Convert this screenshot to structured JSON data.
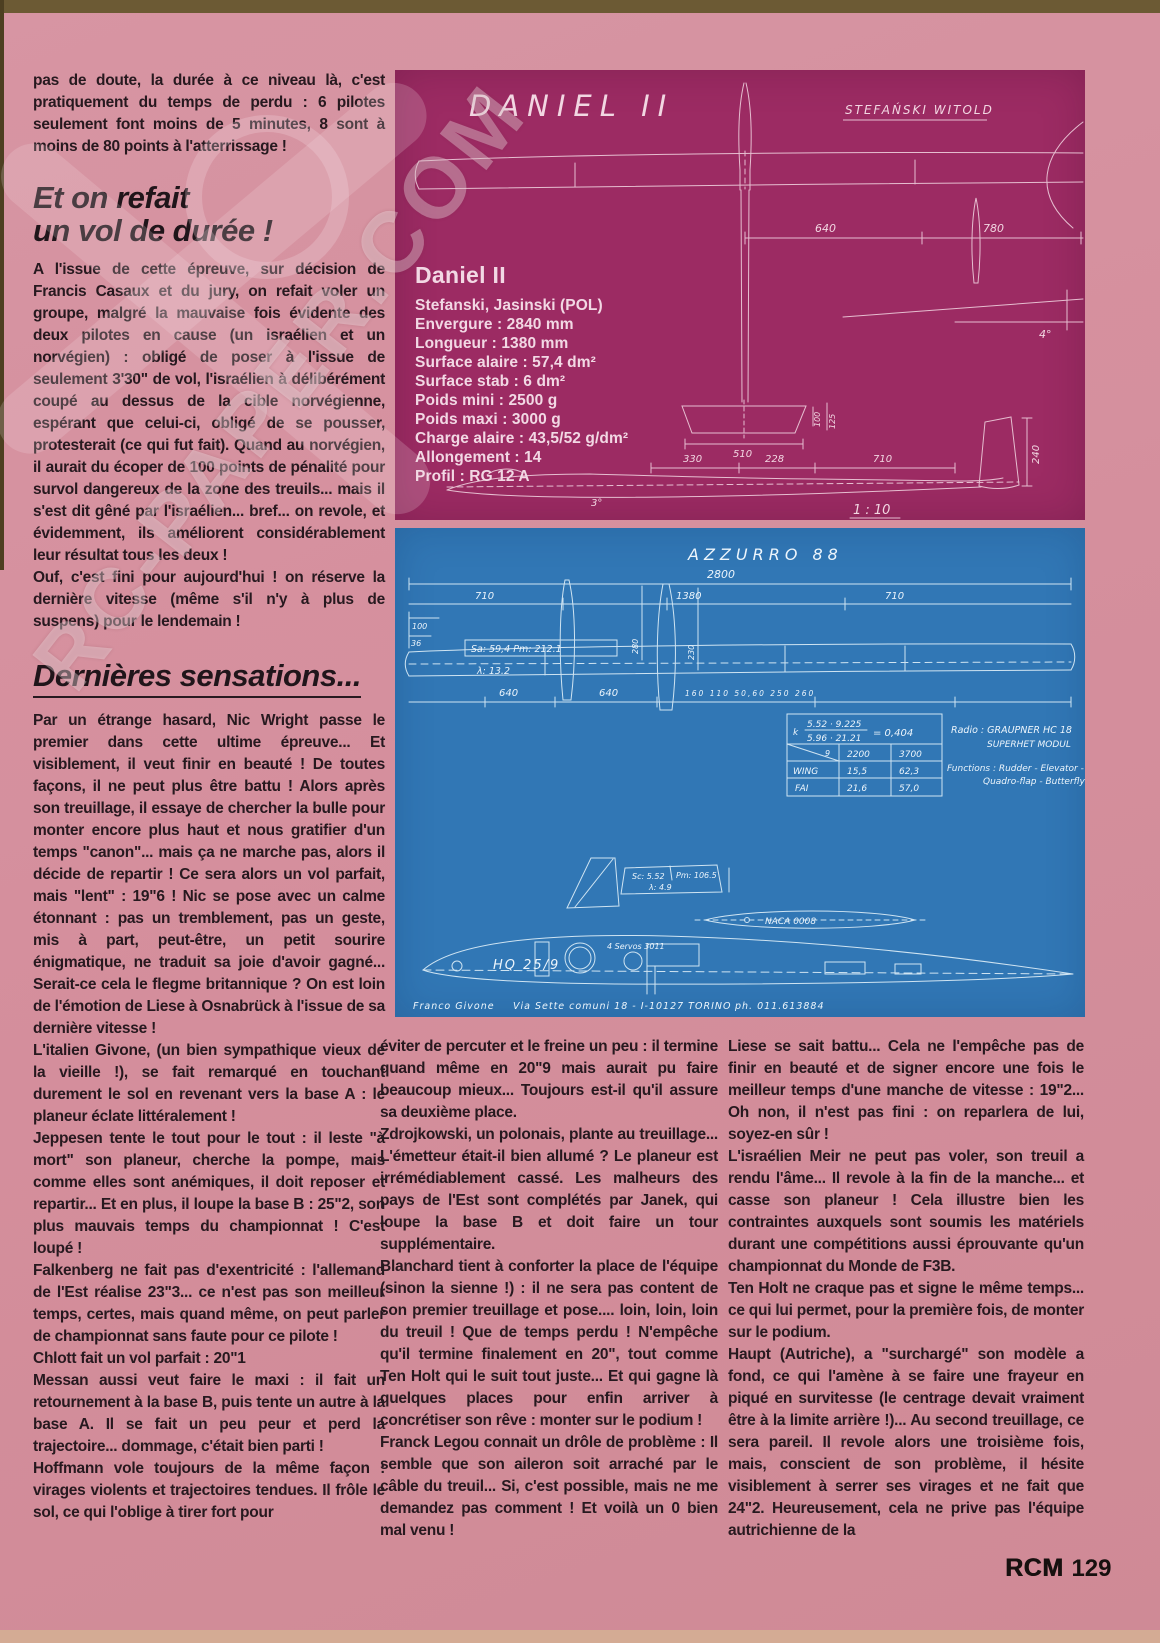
{
  "watermark": {
    "text": "RC-PAPER.COM"
  },
  "footer": {
    "brand": "RCM",
    "page": "129"
  },
  "columns": {
    "left": {
      "p0": "pas de doute, la durée à ce niveau là, c'est pratiquement du temps de perdu : 6 pilotes seulement font moins de 5 minutes, 8 sont à moins de 80 points à l'atterrissage !",
      "h1a": "Et on refait",
      "h1b": "un vol de durée !",
      "p1": "A l'issue de cette épreuve, sur décision de Francis Casaux et du jury, on refait voler un groupe, malgré la mauvaise fois évidente des deux pilotes en cause (un israélien et un norvégien) : obligé de poser à l'issue de seulement 3'30\" de vol, l'israélien à délibérément coupé au dessus de la cible norvégienne, espérant que celui-ci, obligé de se pousser, protesterait (ce qui fut fait). Quand au norvégien, il aurait du écoper de 100 points de pénalité pour survol dangereux de la zone des treuils... mais il s'est dit gêné par l'israélien... bref... on revole, et évidemment, ils améliorent considérablement leur résultat tous les deux !",
      "p2": "Ouf, c'est fini pour aujourd'hui ! on réserve la dernière vitesse (même s'il n'y à plus de suspens) pour le lendemain !",
      "h2": "Dernières sensations...",
      "p3": "Par un étrange hasard, Nic Wright passe le premier dans cette ultime épreuve... Et visiblement, il veut finir en beauté ! De toutes façons, il ne peut plus être battu ! Alors après son treuillage, il essaye de chercher la bulle pour monter encore plus haut et nous gratifier d'un temps \"canon\"... mais ça ne marche pas, alors il décide de repartir ! Ce sera alors un vol parfait, mais \"lent\" : 19\"6 ! Nic se pose avec un calme étonnant : pas un tremblement, pas un geste, mis à part, peut-être, un petit sourire énigmatique, ne traduit sa joie d'avoir gagné... Serait-ce cela le flegme britannique ? On est loin de l'émotion de Liese à Osnabrück à l'issue de sa dernière vitesse !",
      "p4": "L'italien Givone, (un bien sympathique vieux de la vieille !), se fait remarqué en touchant durement le sol en revenant vers la base A : le planeur éclate littéralement !",
      "p5": "Jeppesen tente le tout pour le tout : il leste \"à mort\" son planeur, cherche la pompe, mais comme elles sont anémiques, il doit reposer et repartir... Et en plus, il loupe la base B : 25\"2, son plus mauvais temps du championnat ! C'est loupé !",
      "p6": "Falkenberg ne fait pas d'exentricité : l'allemand de l'Est réalise 23\"3... ce n'est pas son meilleur temps, certes, mais quand même, on peut parler de championnat sans faute pour ce pilote !",
      "p7": "Chlott fait un vol parfait : 20\"1",
      "p8": "Messan aussi veut faire le maxi : il fait un retournement à la base B, puis tente un autre à la base A. Il se fait un peu peur et perd la trajectoire... dommage, c'était bien parti !",
      "p9": "Hoffmann vole toujours de la même façon : virages violents et trajectoires tendues. Il frôle le sol, ce qui l'oblige à tirer fort pour"
    },
    "middle": {
      "p0": "éviter de percuter et le freine un peu : il termine quand même en 20\"9 mais aurait pu faire beaucoup mieux... Toujours est-il qu'il assure sa deuxième place.",
      "p1": "Zdrojkowski, un polonais, plante au treuillage... L'émetteur était-il bien allumé ? Le planeur est irrémédiablement cassé. Les malheurs des pays de l'Est sont complétés par Janek, qui loupe la base B et doit faire un tour supplémentaire.",
      "p2": "Blanchard tient à conforter la place de l'équipe (sinon la sienne !) : il ne sera pas content de son premier treuillage et pose.... loin, loin, loin du treuil ! Que de temps perdu ! N'empêche qu'il termine finalement en 20\", tout comme Ten Holt qui le suit tout juste... Et qui gagne là quelques places pour enfin arriver à concrétiser son rêve : monter sur le podium !",
      "p3": "Franck Legou connait un drôle de problème : Il semble que son aileron soit arraché par le câble du treuil... Si, c'est possible, mais ne me demandez pas comment ! Et voilà un 0 bien mal venu !"
    },
    "right": {
      "p0": "Liese se sait battu... Cela ne l'empêche pas de finir en beauté et de signer encore une fois le meilleur temps d'une manche de vitesse : 19\"2... Oh non, il n'est pas fini : on reparlera de lui, soyez-en sûr !",
      "p1": "L'israélien Meir ne peut pas voler, son treuil a rendu l'âme... Il revole à la fin de la manche... et casse son planeur ! Cela illustre bien les contraintes auxquels sont soumis les matériels durant une compétitions aussi éprouvante qu'un championnat du Monde de F3B.",
      "p2": "Ten Holt ne craque pas et signe le même temps... ce qui lui permet, pour la première fois, de monter sur le podium.",
      "p3": "Haupt (Autriche), a \"surchargé\" son modèle a fond, ce qui l'amène à se faire une frayeur en piqué en survitesse (le centrage devait vraiment être à la limite arrière !)... Au second treuillage, ce sera pareil. Il revole alors une troisième fois, mais, conscient de son problème, il hésite visiblement à serrer ses virages et ne fait que 24\"2. Heureusement, cela ne prive pas l'équipe autrichienne de la"
    }
  },
  "daniel_panel": {
    "sketch_title": "DANIEL II",
    "designer": "STEFAŃSKI WITOLD",
    "spec_title": "Daniel II",
    "spec_team": "Stefanski, Jasinski (POL)",
    "specs": [
      "Envergure : 2840 mm",
      "Longueur : 1380 mm",
      "Surface alaire : 57,4 dm²",
      "Surface stab : 6 dm²",
      "Poids mini : 2500 g",
      "Poids maxi : 3000 g",
      "Charge alaire : 43,5/52 g/dm²",
      "Allongement : 14",
      "Profil : RG 12 A"
    ],
    "dims": {
      "d640": "640",
      "d780": "780",
      "a4": "4°",
      "d510": "510",
      "d100": "100",
      "d125": "125",
      "d330": "330",
      "d228": "228",
      "d710": "710",
      "d240": "240",
      "a3": "3°",
      "scale": "1 : 10"
    }
  },
  "azzurro_panel": {
    "title": "AZZURRO 88",
    "dims": {
      "span": "2800",
      "left": "710",
      "center": "1380",
      "right": "710",
      "d100": "100",
      "d36": "36",
      "d280": "280",
      "d230": "230",
      "sa": "Sa: 59,4   Pm: 212.1",
      "lambda": "λ: 13.2",
      "d640a": "640",
      "d640b": "640",
      "small_row": "160   110   50,60   250   260",
      "sc": "Sc: 5.52",
      "pm": "Pm: 106.5",
      "lambda2": "λ: 4.9",
      "naca": "NACA 0008",
      "airfoil": "HQ 25/9",
      "servos": "4 Servos 3011"
    },
    "table": {
      "k_label": "k",
      "k_num": "5.52 · 9.225",
      "k_den": "5.96 · 21.21",
      "k_result": "= 0,404",
      "head_diag": "9",
      "head_w1": "2200",
      "head_w2": "3700",
      "row1_label": "WING",
      "row1_v1": "15,5",
      "row1_v2": "62,3",
      "row2_label": "FAI",
      "row2_v1": "21,6",
      "row2_v2": "57,0"
    },
    "radio1": "Radio : GRAUPNER HC 18",
    "radio2": "SUPERHET MODUL",
    "functions1": "Functions : Rudder - Elevator -",
    "functions2": "Quadro-flap - Butterfly",
    "credit_name": "Franco Givone",
    "credit_addr": "Via Sette comuni 18 - I-10127 TORINO",
    "credit_phone": "ph. 011.613884"
  }
}
